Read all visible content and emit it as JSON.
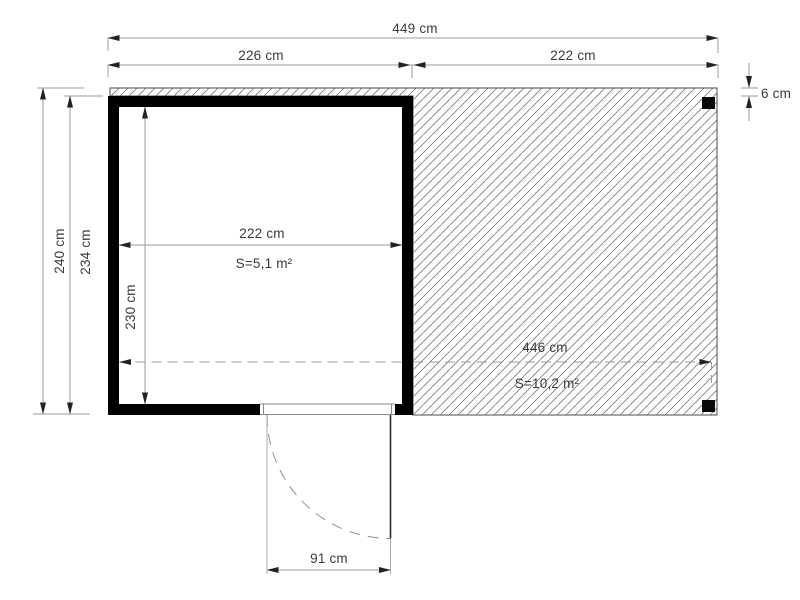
{
  "plan": {
    "dimensions": {
      "overall_width": "449 cm",
      "cabin_width": "226 cm",
      "canopy_width": "222 cm",
      "roof_overhang": "6 cm",
      "overall_depth": "240 cm",
      "cabin_depth": "234 cm",
      "interior_width": "222 cm",
      "interior_depth": "230 cm",
      "interior_area": "S=5,1 m²",
      "canopy_length": "446 cm",
      "canopy_area": "S=10,2 m²",
      "door_width": "91 cm"
    },
    "colors": {
      "wall": "#000000",
      "dimension_line": "#9b9b9b",
      "hatch_line": "#7d7d7d",
      "outline": "#4a4a4a",
      "text": "#3a3a3a",
      "background": "#ffffff"
    }
  }
}
